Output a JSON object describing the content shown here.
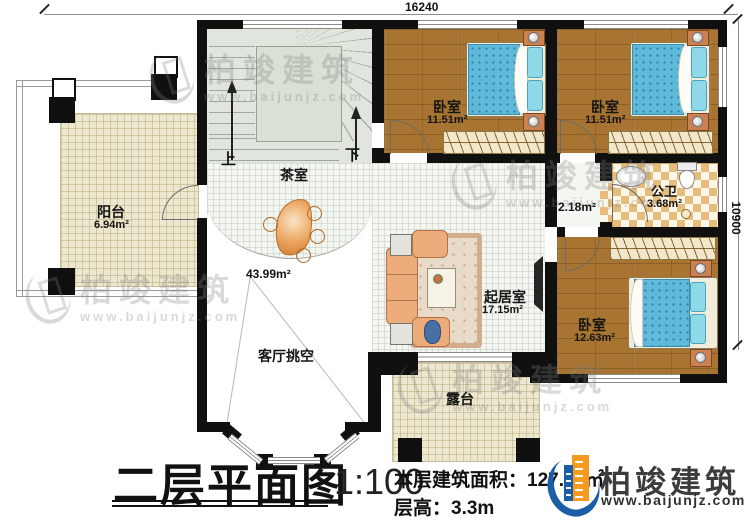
{
  "title_block": {
    "title": "二层平面图",
    "scale": "1:100",
    "area_label": "本层建筑面积：",
    "area_value": "127.51㎡",
    "height_label": "层高：",
    "height_value": "3.3m"
  },
  "dimensions": {
    "top_width": "16240",
    "right_height": "10900"
  },
  "rooms": {
    "balcony": {
      "name": "阳台",
      "area": "6.94m²"
    },
    "tea_room": {
      "name": "茶室"
    },
    "bedroom1": {
      "name": "卧室",
      "area": "11.51m²"
    },
    "bedroom2": {
      "name": "卧室",
      "area": "11.51m²"
    },
    "bathroom": {
      "name": "公卫",
      "area": "3.68m²"
    },
    "hallway": {
      "area": "2.18m²"
    },
    "living_room": {
      "name": "起居室",
      "area": "17.15m²"
    },
    "bedroom3": {
      "name": "卧室",
      "area": "12.63m²"
    },
    "void": {
      "name": "客厅挑空",
      "area": "43.99m²"
    },
    "terrace": {
      "name": "露台"
    }
  },
  "stairs": {
    "up_label": "上",
    "down_label": "下"
  },
  "branding": {
    "watermark_name": "柏竣建筑",
    "watermark_url": "www.baijunjz.com",
    "logo_name": "柏竣建筑",
    "logo_url": "www.baijunjz.com"
  },
  "colors": {
    "wall": "#101010",
    "wood_floor": "#a87431",
    "bed_blue": "#5fb9da",
    "stair_sage": "#e0e6dd",
    "tile_cream": "#ede7d0",
    "bath_tile_tan": "#e7bd7c",
    "logo_blue": "#1b5ea6",
    "logo_orange": "#f5991f"
  }
}
